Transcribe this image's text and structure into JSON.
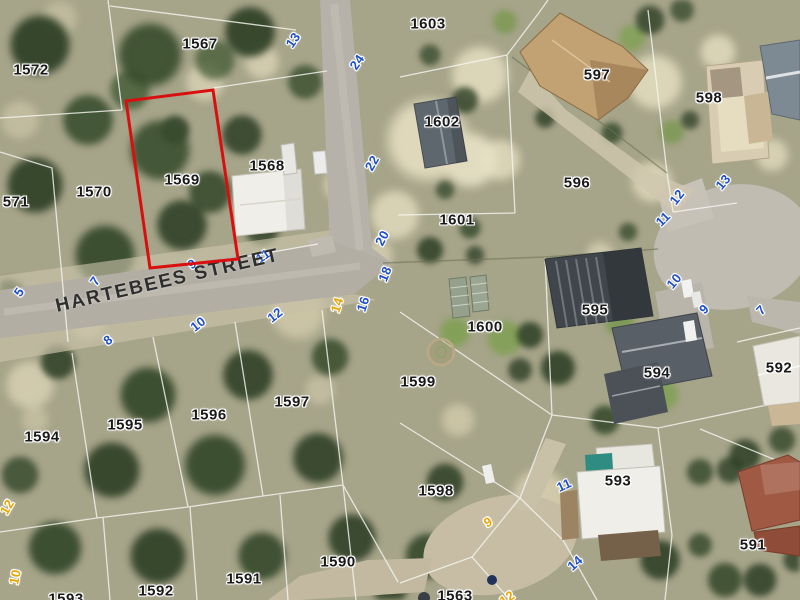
{
  "map": {
    "street_label": "HARTEBEES STREET",
    "highlight": {
      "parcel": "1569",
      "color": "#d90f0f",
      "points": "126,101 213,90 238,259 150,268"
    },
    "colors": {
      "parcel_label": "#191919",
      "address_blue": "#1d4ecb",
      "address_yellow": "#e9a600",
      "street_label": "#2e2e2e"
    },
    "parcels": [
      {
        "t": "1572",
        "x": 31,
        "y": 70
      },
      {
        "t": "1567",
        "x": 200,
        "y": 44
      },
      {
        "t": "1603",
        "x": 428,
        "y": 24
      },
      {
        "t": "1602",
        "x": 442,
        "y": 122
      },
      {
        "t": "597",
        "x": 597,
        "y": 75
      },
      {
        "t": "598",
        "x": 709,
        "y": 98
      },
      {
        "t": "596",
        "x": 577,
        "y": 183
      },
      {
        "t": "1601",
        "x": 457,
        "y": 220
      },
      {
        "t": "1568",
        "x": 267,
        "y": 166
      },
      {
        "t": "1570",
        "x": 94,
        "y": 192
      },
      {
        "t": "571",
        "x": 16,
        "y": 202
      },
      {
        "t": "1569",
        "x": 182,
        "y": 180
      },
      {
        "t": "595",
        "x": 595,
        "y": 310
      },
      {
        "t": "1600",
        "x": 485,
        "y": 327
      },
      {
        "t": "1599",
        "x": 418,
        "y": 382
      },
      {
        "t": "594",
        "x": 657,
        "y": 373
      },
      {
        "t": "592",
        "x": 779,
        "y": 368
      },
      {
        "t": "1598",
        "x": 436,
        "y": 491
      },
      {
        "t": "593",
        "x": 618,
        "y": 481
      },
      {
        "t": "591",
        "x": 753,
        "y": 545
      },
      {
        "t": "1590",
        "x": 338,
        "y": 562
      },
      {
        "t": "1591",
        "x": 244,
        "y": 579
      },
      {
        "t": "1592",
        "x": 156,
        "y": 591
      },
      {
        "t": "1593",
        "x": 66,
        "y": 599
      },
      {
        "t": "1563",
        "x": 455,
        "y": 596
      },
      {
        "t": "1594",
        "x": 42,
        "y": 437
      },
      {
        "t": "1595",
        "x": 125,
        "y": 425
      },
      {
        "t": "1596",
        "x": 209,
        "y": 415
      },
      {
        "t": "1597",
        "x": 292,
        "y": 402
      }
    ],
    "addresses_blue": [
      {
        "t": "13",
        "x": 293,
        "y": 40,
        "r": -55
      },
      {
        "t": "24",
        "x": 357,
        "y": 62,
        "r": -55
      },
      {
        "t": "22",
        "x": 372,
        "y": 163,
        "r": -60
      },
      {
        "t": "20",
        "x": 382,
        "y": 238,
        "r": -62
      },
      {
        "t": "18",
        "x": 385,
        "y": 274,
        "r": -68
      },
      {
        "t": "16",
        "x": 363,
        "y": 304,
        "r": -72
      },
      {
        "t": "11",
        "x": 263,
        "y": 256,
        "r": -35
      },
      {
        "t": "9",
        "x": 192,
        "y": 264,
        "r": -35
      },
      {
        "t": "12",
        "x": 275,
        "y": 315,
        "r": -38
      },
      {
        "t": "10",
        "x": 198,
        "y": 324,
        "r": -38
      },
      {
        "t": "8",
        "x": 108,
        "y": 340,
        "r": -38
      },
      {
        "t": "7",
        "x": 95,
        "y": 281,
        "r": -55
      },
      {
        "t": "5",
        "x": 19,
        "y": 292,
        "r": -55
      },
      {
        "t": "13",
        "x": 723,
        "y": 182,
        "r": -50
      },
      {
        "t": "12",
        "x": 677,
        "y": 197,
        "r": -52
      },
      {
        "t": "11",
        "x": 663,
        "y": 219,
        "r": -45
      },
      {
        "t": "10",
        "x": 674,
        "y": 281,
        "r": -50
      },
      {
        "t": "9",
        "x": 704,
        "y": 309,
        "r": -45
      },
      {
        "t": "7",
        "x": 761,
        "y": 310,
        "r": -45
      },
      {
        "t": "11",
        "x": 564,
        "y": 485,
        "r": -25
      },
      {
        "t": "14",
        "x": 575,
        "y": 563,
        "r": -42
      }
    ],
    "addresses_yellow": [
      {
        "t": "14",
        "x": 337,
        "y": 305,
        "r": -72
      },
      {
        "t": "12",
        "x": 7,
        "y": 507,
        "r": -60
      },
      {
        "t": "10",
        "x": 15,
        "y": 577,
        "r": -78
      },
      {
        "t": "9",
        "x": 488,
        "y": 522,
        "r": -28
      },
      {
        "t": "12",
        "x": 507,
        "y": 598,
        "r": -35
      }
    ]
  }
}
